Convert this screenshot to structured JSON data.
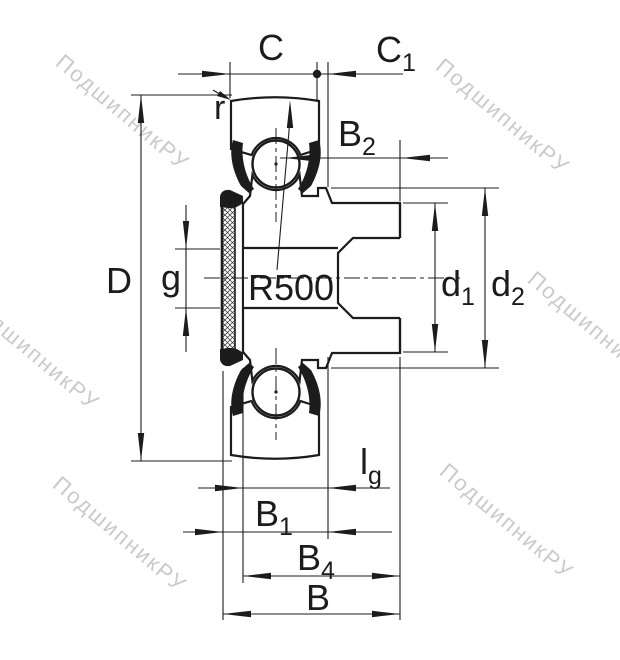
{
  "drawing": {
    "kind": "bearing-cross-section",
    "radius_callout": "R500"
  },
  "labels": {
    "c": {
      "base": "C",
      "sub": ""
    },
    "c1": {
      "base": "C",
      "sub": "1"
    },
    "r": {
      "base": "r",
      "sub": ""
    },
    "b2": {
      "base": "B",
      "sub": "2"
    },
    "d_outer": {
      "base": "D",
      "sub": ""
    },
    "g": {
      "base": "g",
      "sub": ""
    },
    "r500": {
      "base": "R500",
      "sub": ""
    },
    "d1": {
      "base": "d",
      "sub": "1"
    },
    "d2": {
      "base": "d",
      "sub": "2"
    },
    "lg": {
      "base": "l",
      "sub": "g"
    },
    "b1": {
      "base": "B",
      "sub": "1"
    },
    "b4": {
      "base": "B",
      "sub": "4"
    },
    "b": {
      "base": "B",
      "sub": ""
    }
  },
  "watermark": {
    "text": "ПодшипникРУ",
    "color": "#bdbdbd"
  },
  "colors": {
    "line": "#1c1c1c",
    "background": "#ffffff"
  }
}
